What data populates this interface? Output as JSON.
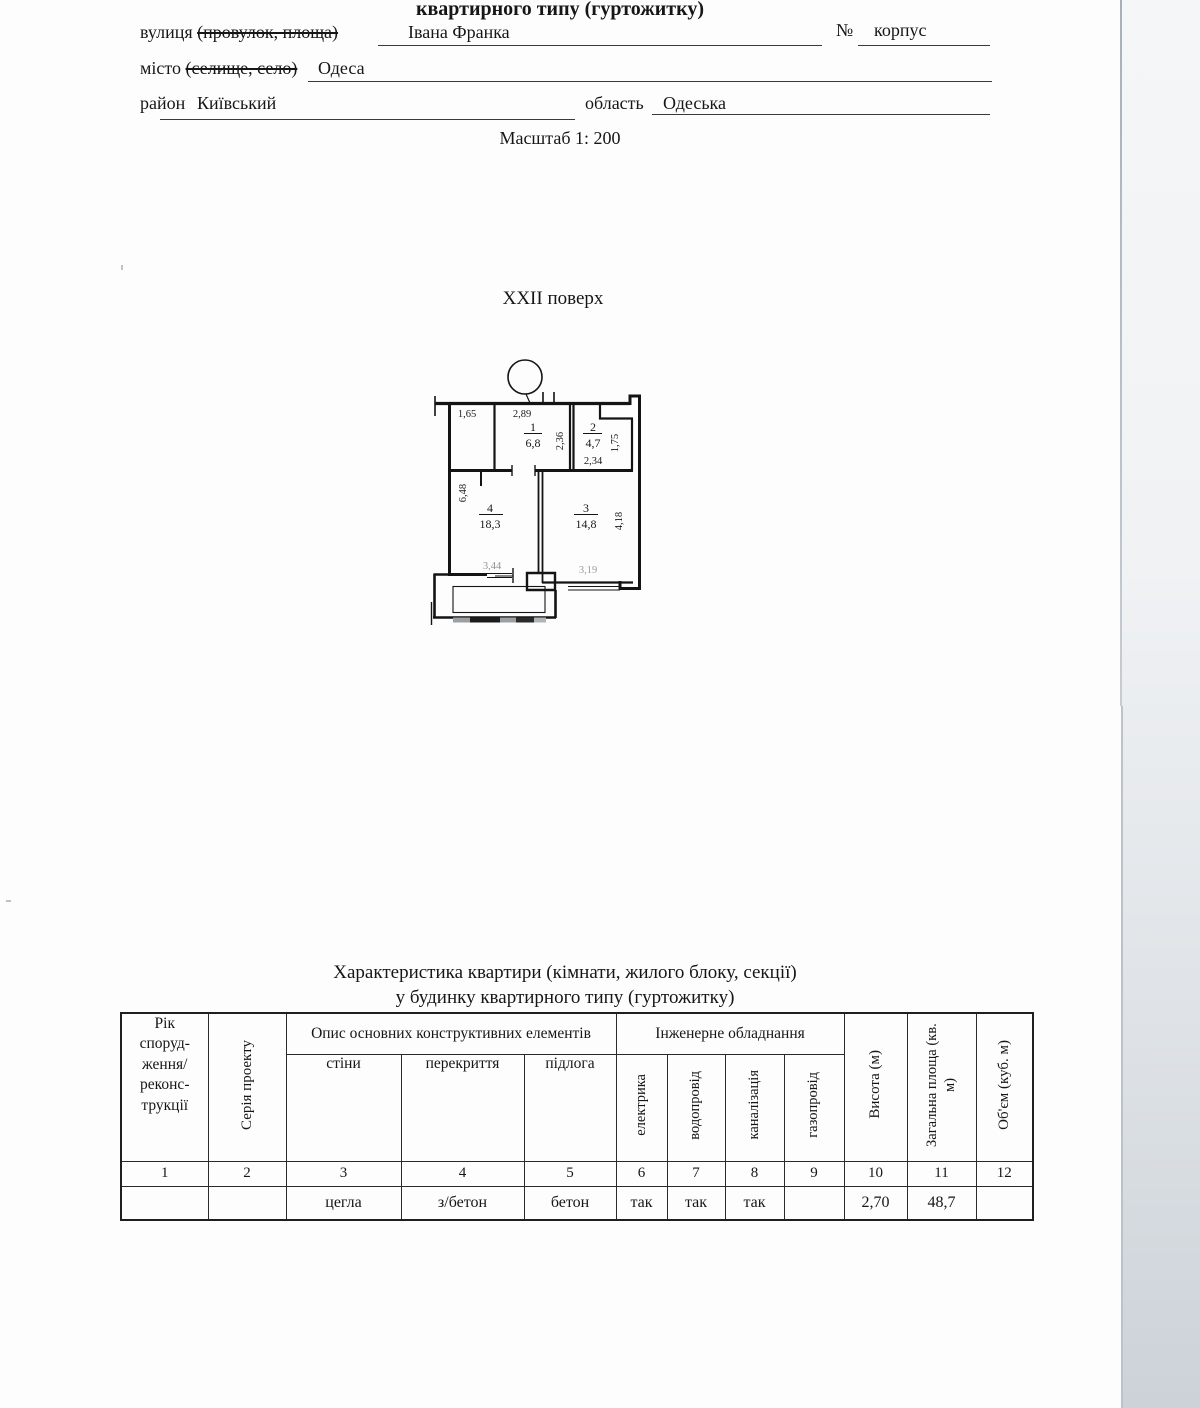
{
  "page": {
    "header_title": "квартирного типу (гуртожитку)",
    "scale": "Масштаб 1: 200",
    "floor_title": "XXII поверх"
  },
  "form": {
    "street_label": "вулиця",
    "street_struck": "(провулок, площа)",
    "street_value": "Івана Франка",
    "no_label": "№",
    "korpus_label": "корпус",
    "city_label": "місто",
    "city_struck": "(селище, село)",
    "city_value": "Одеса",
    "district_label": "район",
    "district_value": "Київський",
    "oblast_label": "область",
    "oblast_value": "Одеська"
  },
  "plan": {
    "room1_num": "1",
    "room1_area": "6,8",
    "room2_num": "2",
    "room2_area": "4,7",
    "room3_num": "3",
    "room3_area": "14,8",
    "room4_num": "4",
    "room4_area": "18,3",
    "dim_165": "1,65",
    "dim_289": "2,89",
    "dim_236": "2,36",
    "dim_234": "2,34",
    "dim_175": "1,75",
    "dim_648": "6,48",
    "dim_418": "4,18",
    "dim_344": "3,44",
    "dim_319": "3,19"
  },
  "table": {
    "title_line1": "Характеристика квартири (кімнати, жилого блоку, секції)",
    "title_line2": "у будинку квартирного типу (гуртожитку)",
    "headers": {
      "col1": "Рік\nспоруд-\nження/\nреконс-\nтрукції",
      "col2": "Серія проекту",
      "group_construct": "Опис основних конструктивних елементів",
      "col3": "стіни",
      "col4": "перекриття",
      "col5": "підлога",
      "group_engineering": "Інженерне обладнання",
      "col6": "електрика",
      "col7": "водопровід",
      "col8": "каналізація",
      "col9": "газопровід",
      "col10": "Висота (м)",
      "col11": "Загальна площа (кв. м)",
      "col12": "Об'єм (куб. м)"
    },
    "number_row": [
      "1",
      "2",
      "3",
      "4",
      "5",
      "6",
      "7",
      "8",
      "9",
      "10",
      "11",
      "12"
    ],
    "data_row": [
      "",
      "",
      "цегла",
      "з/бетон",
      "бетон",
      "так",
      "так",
      "так",
      "",
      "2,70",
      "48,7",
      ""
    ]
  }
}
